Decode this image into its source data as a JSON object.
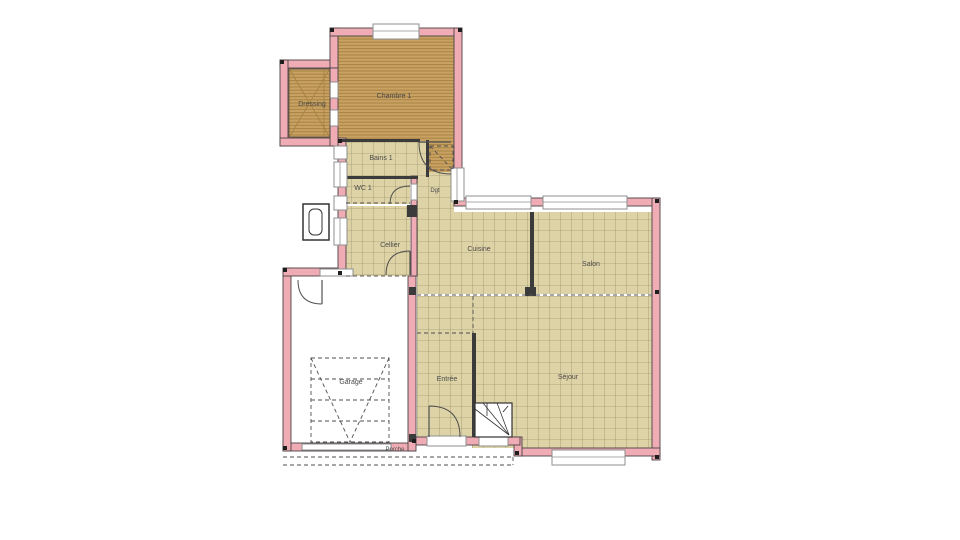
{
  "colors": {
    "bg": "#ffffff",
    "wall": "#efacb4",
    "wallline": "#4a4246",
    "iwall": "#3b3b3b",
    "wood": "#c9a263",
    "woodline": "#a3803f",
    "tile": "#ded3a6",
    "tileline": "#85805c",
    "window": "#ffffff",
    "winborder": "#8f8f8f",
    "line": "#4f4f4f",
    "label": "#4a4a4a"
  },
  "rooms": {
    "dressing": "Dressing",
    "chambre": "Chambre 1",
    "bains": "Bains 1",
    "wc": "WC 1",
    "dgt": "Dgt",
    "cellier": "Cellier",
    "cuisine": "Cuisine",
    "salon": "Salon",
    "entree": "Entrée",
    "sejour": "Séjour",
    "garage": "Garage",
    "porche": "Porche"
  }
}
